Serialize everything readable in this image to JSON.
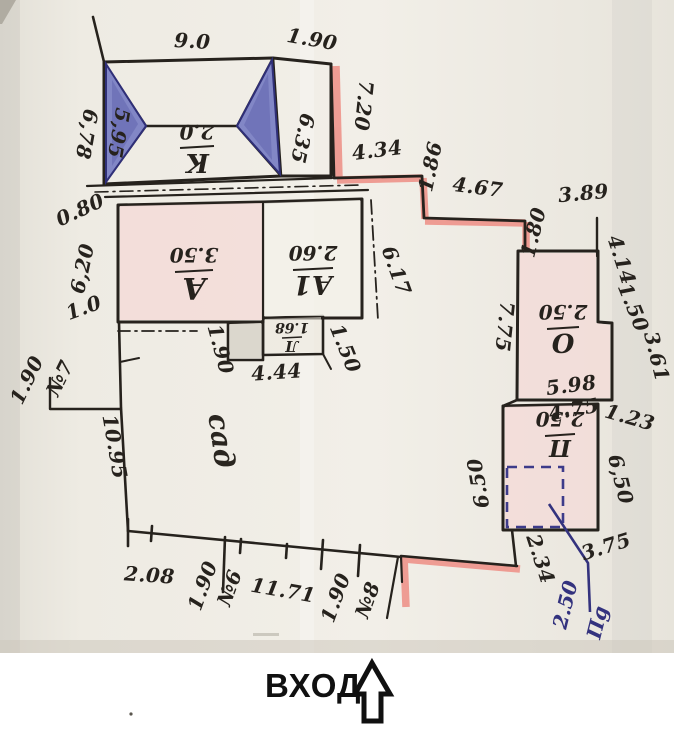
{
  "colors": {
    "paper": "#efece4",
    "ink": "#26221d",
    "red_highlight": "#ee8e85",
    "pink_room": "#f3dcd8",
    "roof_blue": "#8287c6",
    "roof_blue_dark": "#2f2f78",
    "grey_annex": "#d8d4ca",
    "blue_ink": "#33327e"
  },
  "entrance": {
    "label": "ВХОД"
  },
  "garden": {
    "label": "сад"
  },
  "rooms": {
    "k": {
      "letter": "К",
      "value": "2.0"
    },
    "a": {
      "letter": "А",
      "value": "3.50"
    },
    "a1": {
      "letter": "А1",
      "value": "2.60"
    },
    "l": {
      "letter": "Л",
      "value": "1.68"
    },
    "o": {
      "letter": "О",
      "value": "2.50"
    },
    "p": {
      "letter": "П",
      "value": "2.50"
    },
    "pg": {
      "letter": "Пg",
      "value": "2.50"
    }
  },
  "dims": {
    "k_top": "9.0",
    "k_top_right": "1.90",
    "k_left_outer": "6,78",
    "k_left_inner": "5,95",
    "k_right_inner": "6.35",
    "red_v1": "7.20",
    "red_h1": "4.34",
    "red_v2": "1.86",
    "red_h2": "4.67",
    "red_v3": "1.80",
    "o_top": "3.89",
    "o_right_upper": "4.14",
    "o_right_step": "1.50",
    "o_right_lower": "3.61",
    "o_left": "7.75",
    "o_bottom": "5.98",
    "p_top": "4.75",
    "p_right_gap": "1.23",
    "p_left": "6.50",
    "p_right": "6,50",
    "p_below_diag": "3.75",
    "p_below_left": "2.34",
    "a_gap": "0.80",
    "a_left": "6,20",
    "a_left_low": "1.0",
    "a1_right": "6.17",
    "annex_left": "1.90",
    "annex_bottom": "4.44",
    "annex_right": "1.50",
    "w_n7_dist": "1.90",
    "w_n7": "№7",
    "w_len": "10.95",
    "b_1": "2.08",
    "b_2": "1.90",
    "b_n6": "№6",
    "b_3": "11.71",
    "b_4": "1.90",
    "b_n8": "№8"
  }
}
